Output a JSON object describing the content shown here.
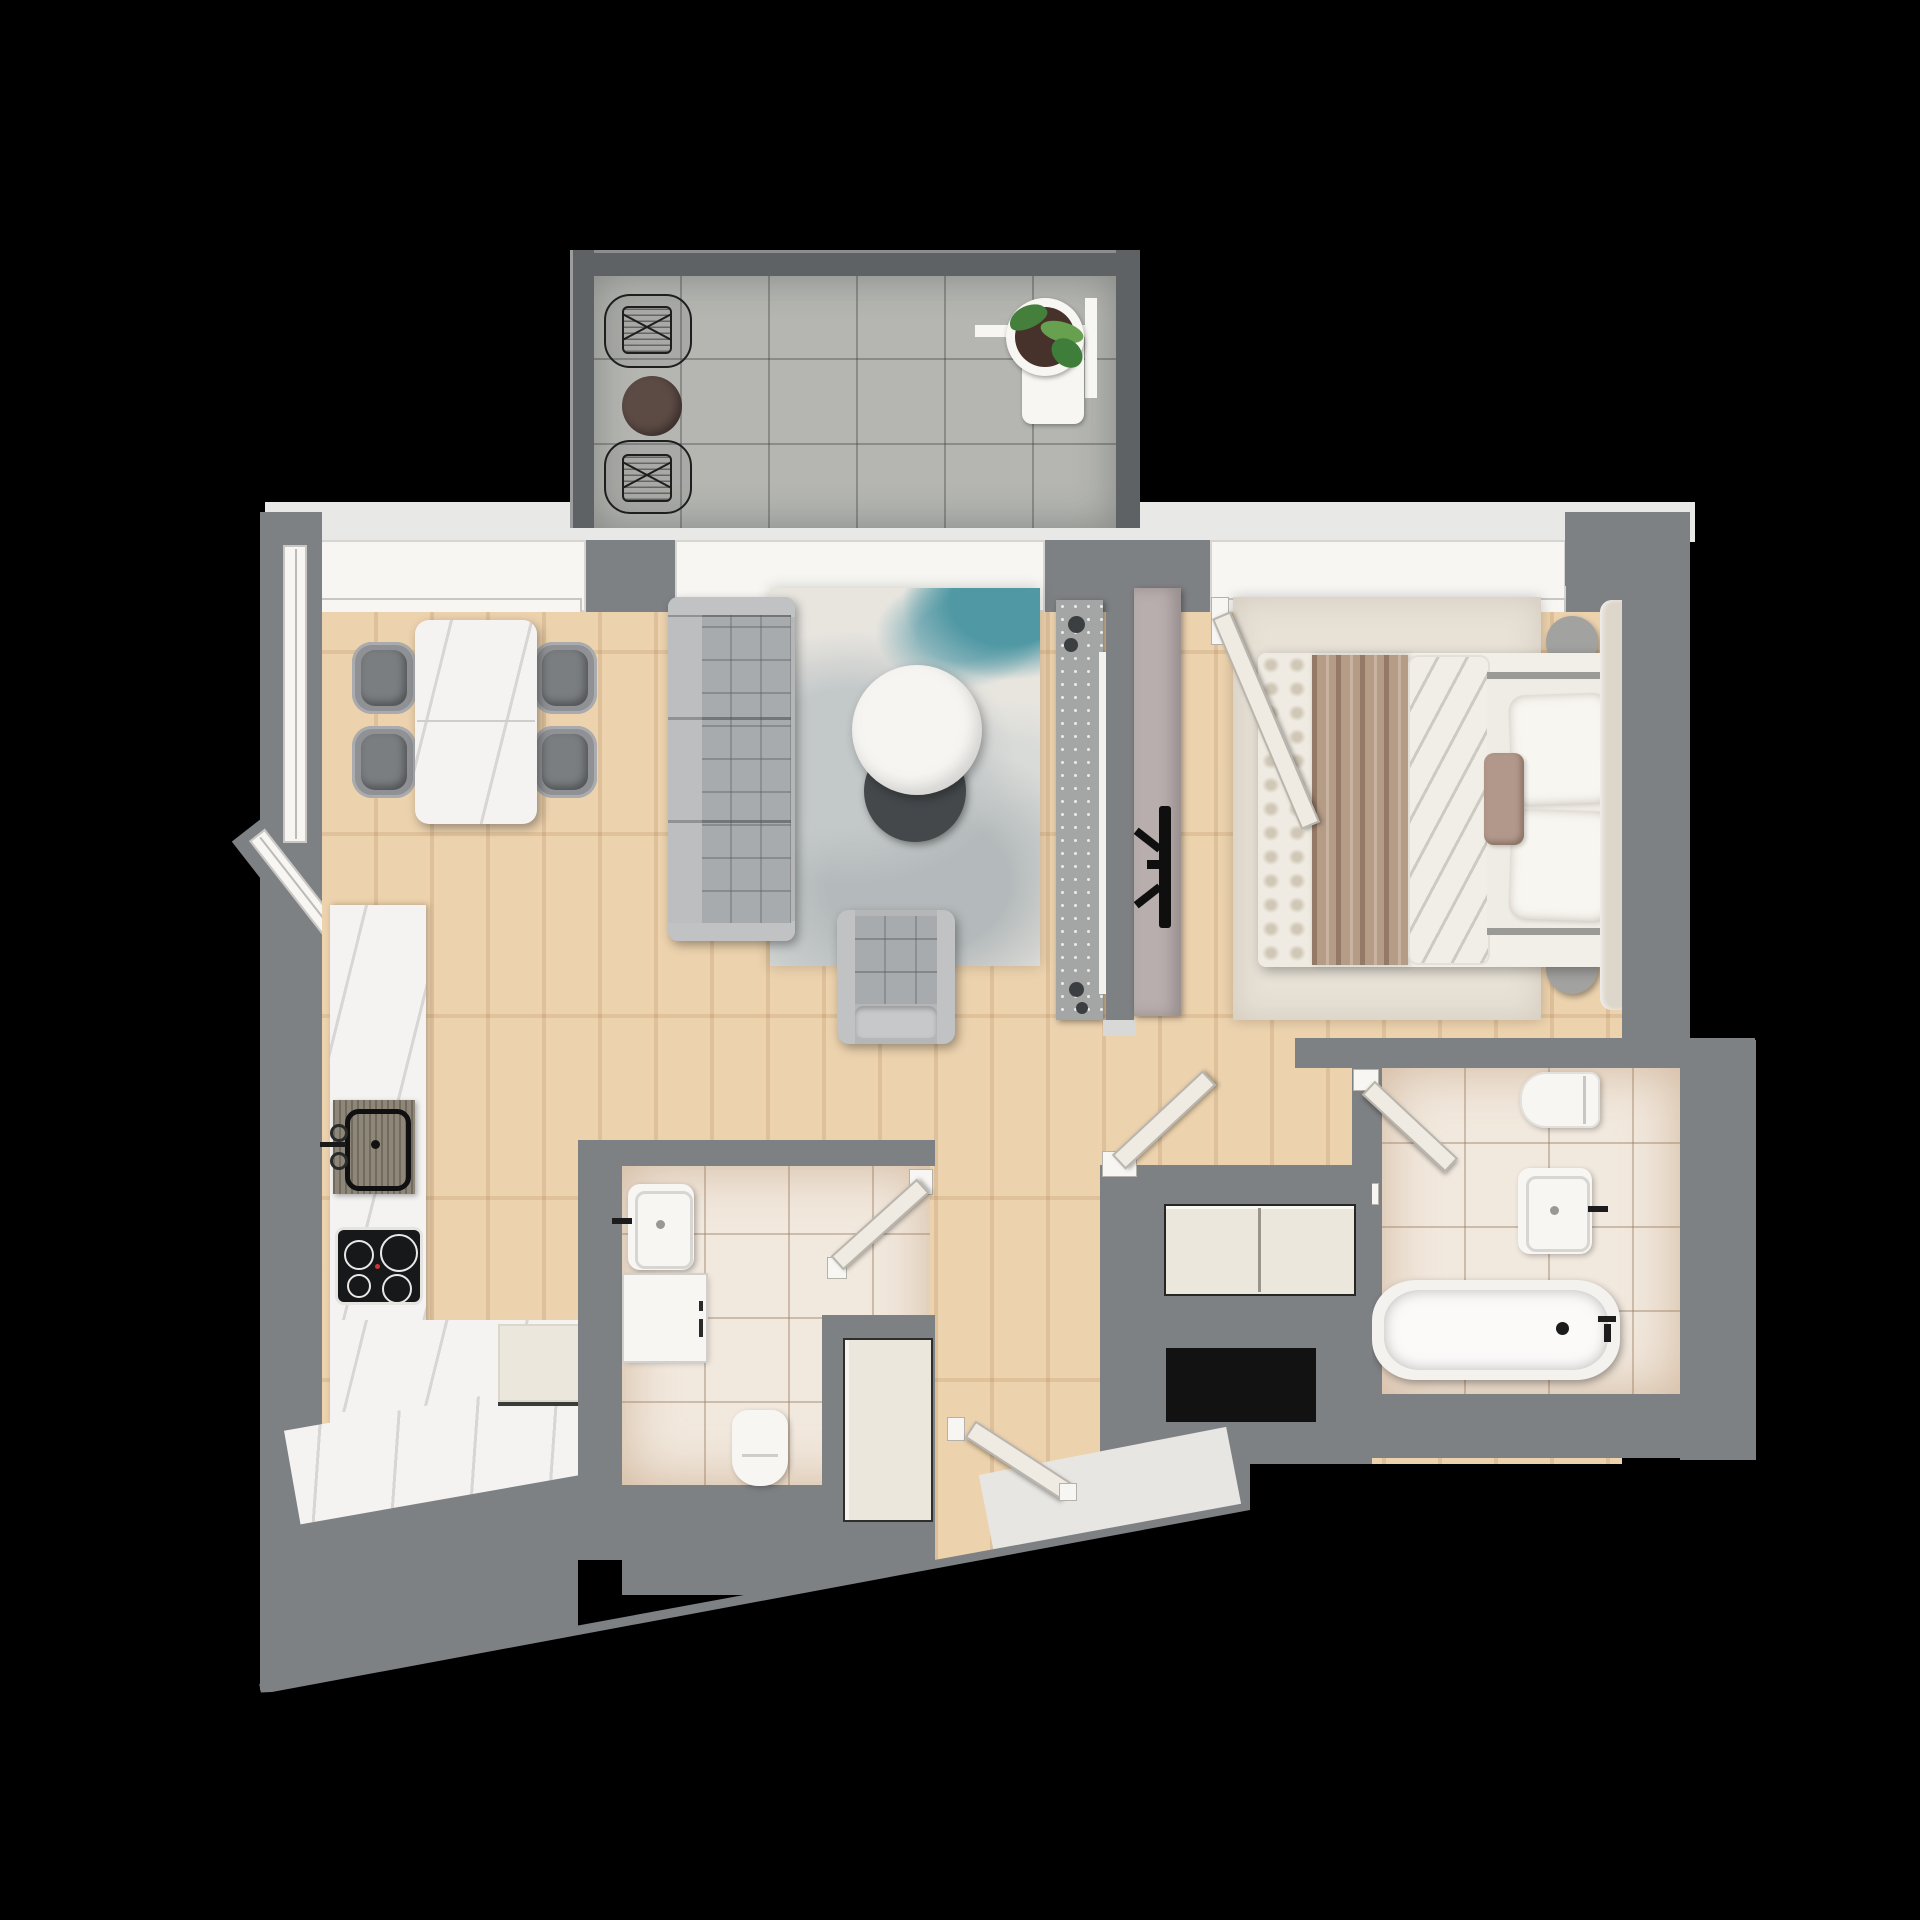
{
  "meta": {
    "kind": "architectural-floor-plan",
    "style": "top-down 3D rendered apartment plan on black background",
    "visible_text": "none"
  },
  "palette": {
    "bg": "#000000",
    "wall": "#7e8184",
    "balcony-wall": "#5e6265",
    "balcony-floor": "#b5b6b2",
    "wood-a": "#ebcfa8",
    "marble": "#f4f3f1",
    "tile": "#f2e9de",
    "tile-line": "rgba(150,120,95,0.40)",
    "fixture-white": "#f7f6f3",
    "cream": "#ece7dd",
    "door-leaf": "#efebe3",
    "sofa-base": "#b4b6b8",
    "sofa-cushion": "#a8abad",
    "chair-gray": "#8f9194",
    "chair-dark": "#7b7e81",
    "rug-base": "#e8e5df",
    "rug-teal": "#4f98a4",
    "coffee-white": "#f6f5f2",
    "coffee-dark": "#44484b",
    "media-panel": "#a4a6a5",
    "mauve-board": "#b9aeae",
    "headboard": "#ddd6ca",
    "bed-white": "#f2efe9",
    "throw-brown": "#b59c87",
    "pillow": "#f8f6f1",
    "accent-pillow": "#b1988a",
    "bedroom-rug": "#e7e1d6",
    "balcony-table": "#5c4a44",
    "plant-green": "#44803c",
    "soil": "#46322a",
    "cooktop": "#17181a",
    "sink-board": "#8e8779",
    "dark-opening": "#1c1c1a",
    "niche": "#121212"
  },
  "rooms": [
    {
      "name": "balcony",
      "furniture": [
        "wireframe-chair",
        "wireframe-chair",
        "round-side-table",
        "potted-plant-on-stand"
      ]
    },
    {
      "name": "living-dining-room",
      "furniture": [
        "dining-table",
        "dining-chair",
        "dining-chair",
        "dining-chair",
        "dining-chair",
        "sofa",
        "area-rug",
        "coffee-table-white",
        "coffee-table-dark",
        "armchair",
        "media-panel"
      ]
    },
    {
      "name": "kitchen",
      "furniture": [
        "l-shaped-countertop",
        "sink-with-cutting-board",
        "induction-cooktop",
        "built-in-appliance"
      ]
    },
    {
      "name": "bedroom",
      "furniture": [
        "double-bed",
        "throw-blanket",
        "pillows",
        "bedside-table",
        "bedside-table",
        "rug",
        "headboard",
        "tv-sideboard",
        "wall-tv"
      ]
    },
    {
      "name": "bathroom",
      "furniture": [
        "washbasin",
        "washing-machine",
        "toilet"
      ]
    },
    {
      "name": "ensuite-bathroom",
      "furniture": [
        "toilet",
        "washbasin",
        "bathtub"
      ]
    },
    {
      "name": "hallway",
      "furniture": [
        "storage-cabinet",
        "entrance-door",
        "threshold"
      ]
    }
  ],
  "doors": [
    "balcony-sliding-door",
    "bedroom-door",
    "bathroom-door",
    "ensuite-door",
    "entrance-door"
  ],
  "windows": [
    "dining-top-window",
    "dining-left-window",
    "dining-corner-window",
    "balcony-door-window",
    "bedroom-window",
    "bedroom-open-casement"
  ]
}
